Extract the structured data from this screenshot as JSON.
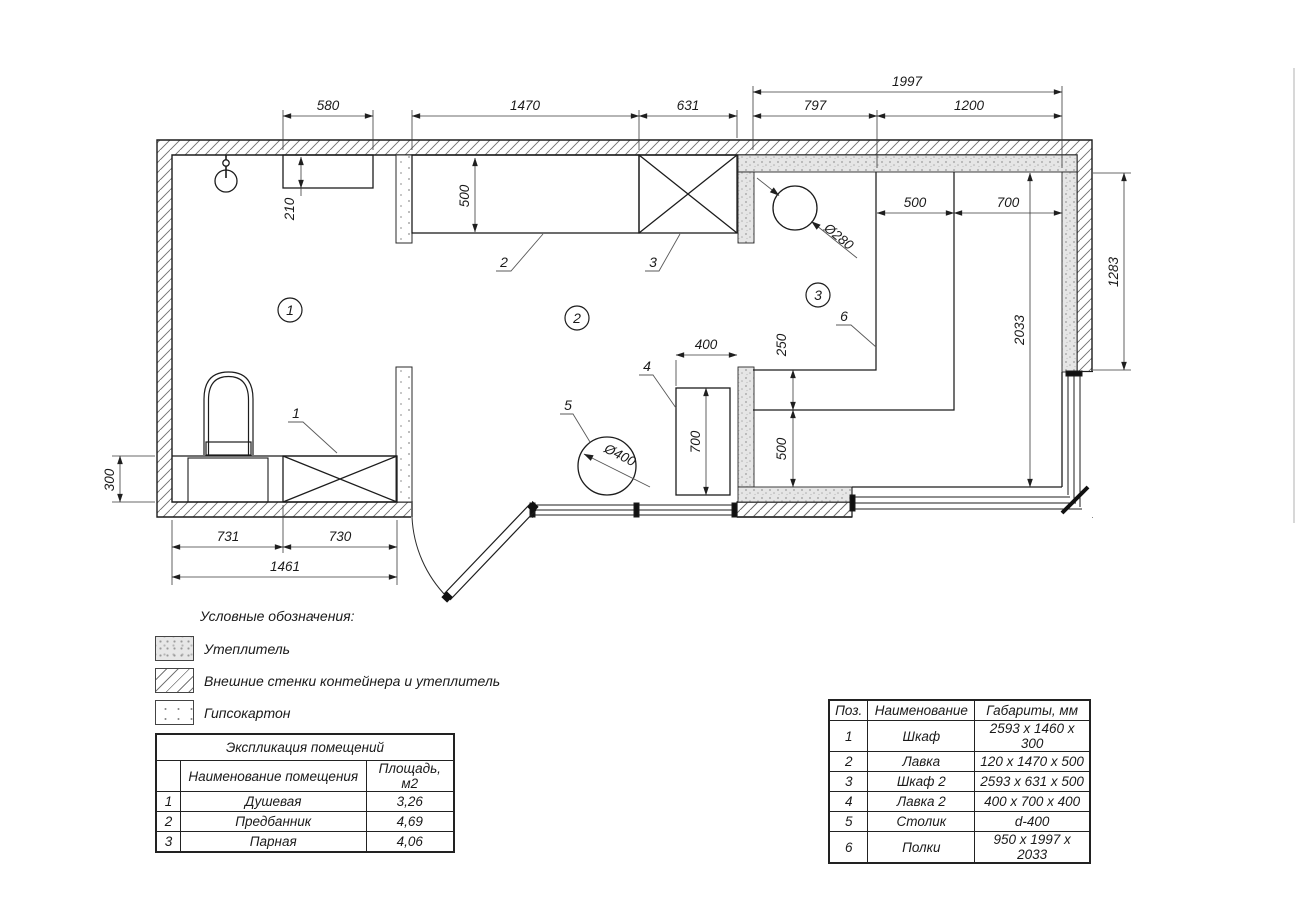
{
  "plan": {
    "dims": {
      "w580": "580",
      "w1470": "1470",
      "w631": "631",
      "w1997": "1997",
      "w797": "797",
      "w1200": "1200",
      "h210": "210",
      "h500bench": "500",
      "w500shelf": "500",
      "w700shelf": "700",
      "h1283": "1283",
      "h2033": "2033",
      "h250": "250",
      "h500sauna": "500",
      "w400bench": "400",
      "h700bench": "700",
      "h300": "300",
      "w731": "731",
      "w730": "730",
      "w1461": "1461",
      "dia280": "Ø280",
      "dia400": "Ø400"
    },
    "rooms": {
      "r1": "1",
      "r2": "2",
      "r3": "3"
    },
    "items": {
      "i1": "1",
      "i2": "2",
      "i3": "3",
      "i4": "4",
      "i5": "5",
      "i6": "6"
    }
  },
  "legend": {
    "title": "Условные обозначения:",
    "items": [
      {
        "label": "Утеплитель"
      },
      {
        "label": "Внешние стенки контейнера и утеплитель"
      },
      {
        "label": "Гипсокартон"
      }
    ]
  },
  "explication": {
    "title": "Экспликация помещений",
    "col_name": "Наименование помещения",
    "col_area": "Площадь, м2",
    "rows": [
      {
        "num": "1",
        "name": "Душевая",
        "area": "3,26"
      },
      {
        "num": "2",
        "name": "Предбанник",
        "area": "4,69"
      },
      {
        "num": "3",
        "name": "Парная",
        "area": "4,06"
      }
    ]
  },
  "furniture": {
    "col_pos": "Поз.",
    "col_name": "Наименование",
    "col_size": "Габариты, мм",
    "rows": [
      {
        "pos": "1",
        "name": "Шкаф",
        "size": "2593 x 1460 x 300"
      },
      {
        "pos": "2",
        "name": "Лавка",
        "size": "120 x 1470 x 500"
      },
      {
        "pos": "3",
        "name": "Шкаф 2",
        "size": "2593 x 631 x 500"
      },
      {
        "pos": "4",
        "name": "Лавка 2",
        "size": "400 x 700 x 400"
      },
      {
        "pos": "5",
        "name": "Столик",
        "size": "d-400"
      },
      {
        "pos": "6",
        "name": "Полки",
        "size": "950 x 1997 x 2033"
      }
    ]
  }
}
